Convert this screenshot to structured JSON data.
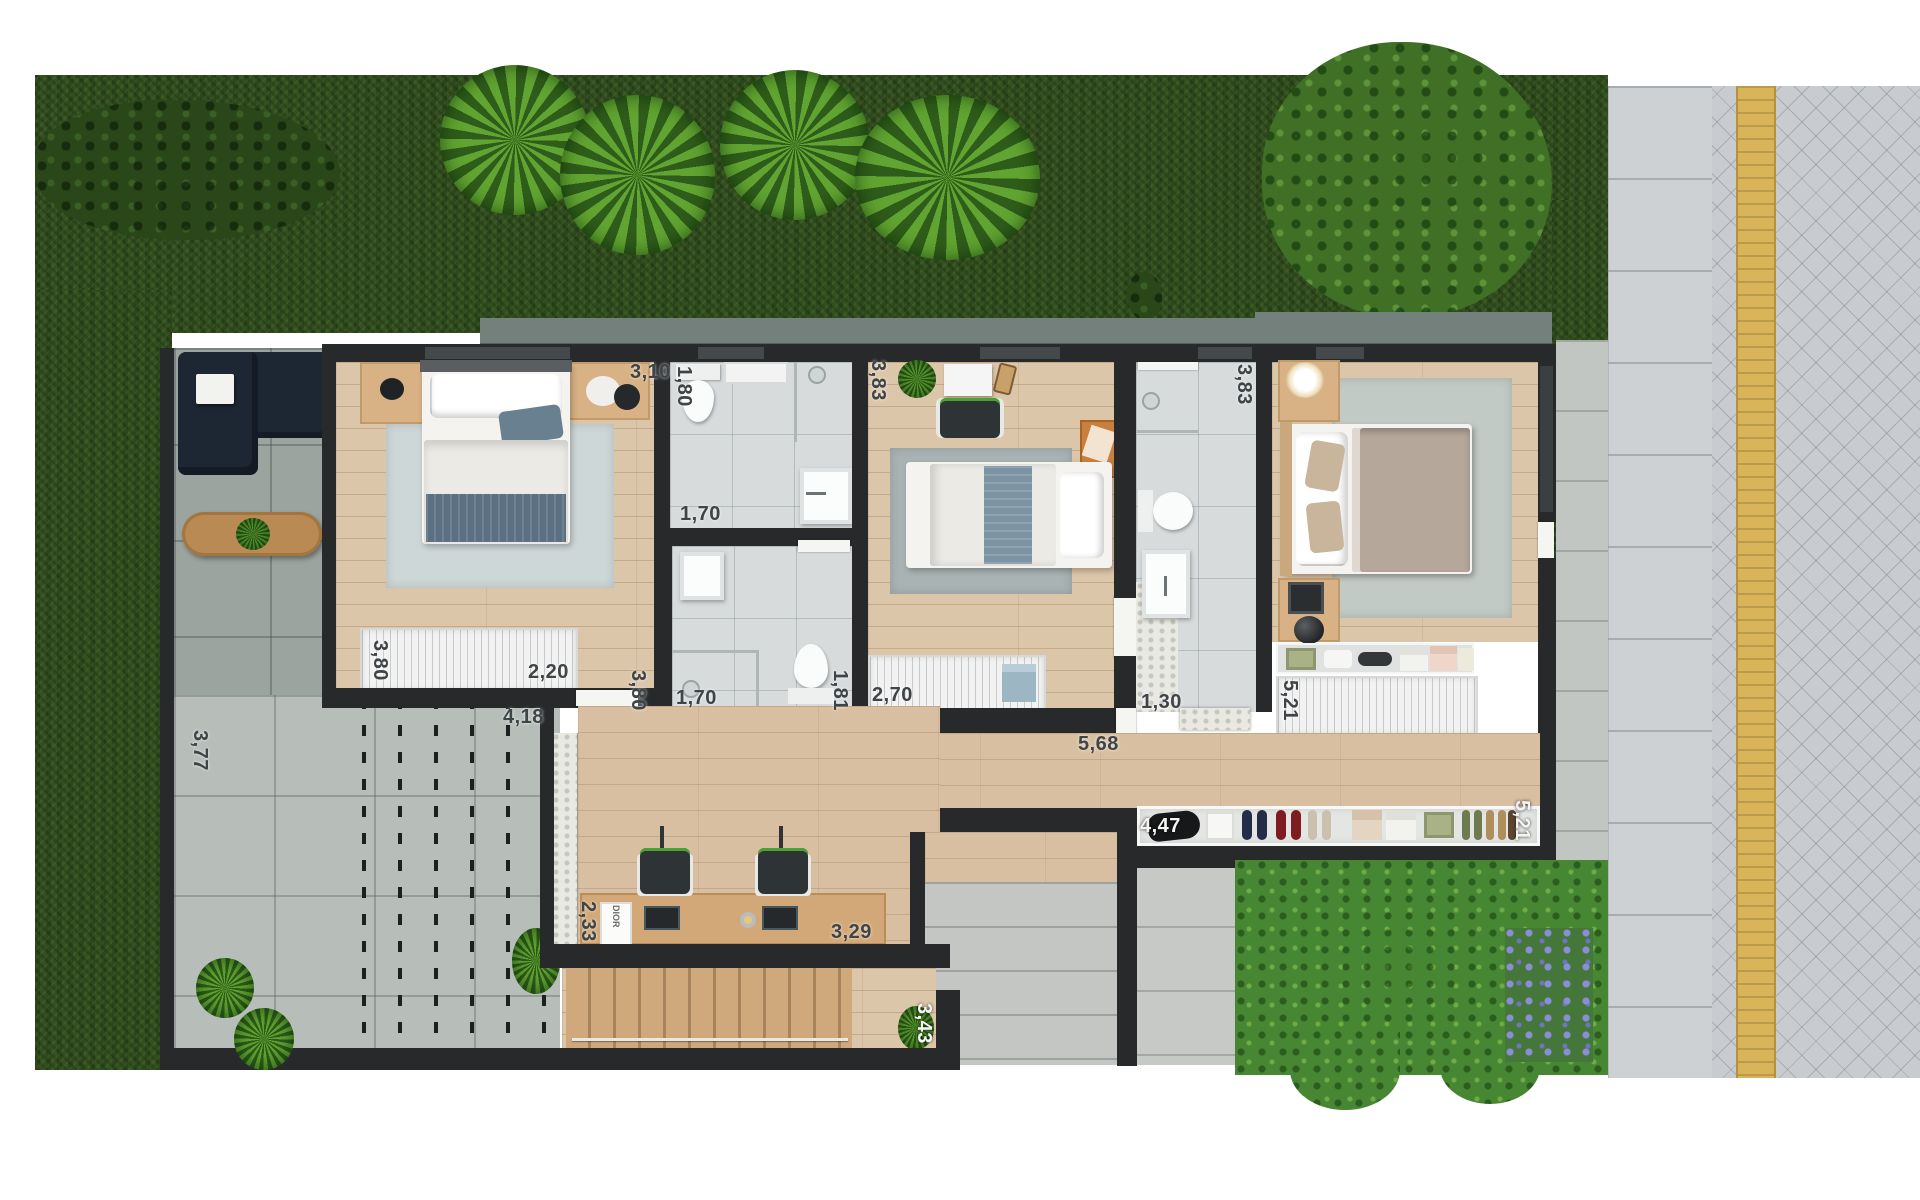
{
  "title": "Residential floor plan - rendered top view",
  "dimension_labels": {
    "bedroom1_width_top": "3,10",
    "bath_a_width": "1,80",
    "bath_a_length": "1,70",
    "bedroom2_width": "3,83",
    "bath_c_length": "1,70",
    "bath_c_width": "1,81",
    "bedroom1_depth": "3,80",
    "bedroom1_wardrobe": "3,80",
    "bedroom1_wardrobe_width": "2,20",
    "deck_width": "4,18",
    "bedroom2_wardrobe": "2,70",
    "bath_b_width": "1,30",
    "bath_b_depth": "3,83",
    "master_closet_depth": "5,21",
    "entry_closet_width": "4,47",
    "right_side_depth": "5,21",
    "hall_length": "5,68",
    "office_depth": "2,33",
    "office_width": "3,29",
    "stair_width": "3,43",
    "patio_depth": "3,77"
  },
  "furniture_text": {
    "dior_box": "DIOR"
  },
  "colors": {
    "grass": "#33511e",
    "wood_floor": "#dcc6a9",
    "wall": "#27292b",
    "roof_fascia": "#74807b",
    "bathroom_tile": "#d7dbdc",
    "tactile_strip": "#d9b458",
    "label_dark": "#3f4447",
    "label_light": "#f4f4f2",
    "sofa_navy": "#1d2733",
    "accent_chair_green": "#4aa233"
  }
}
